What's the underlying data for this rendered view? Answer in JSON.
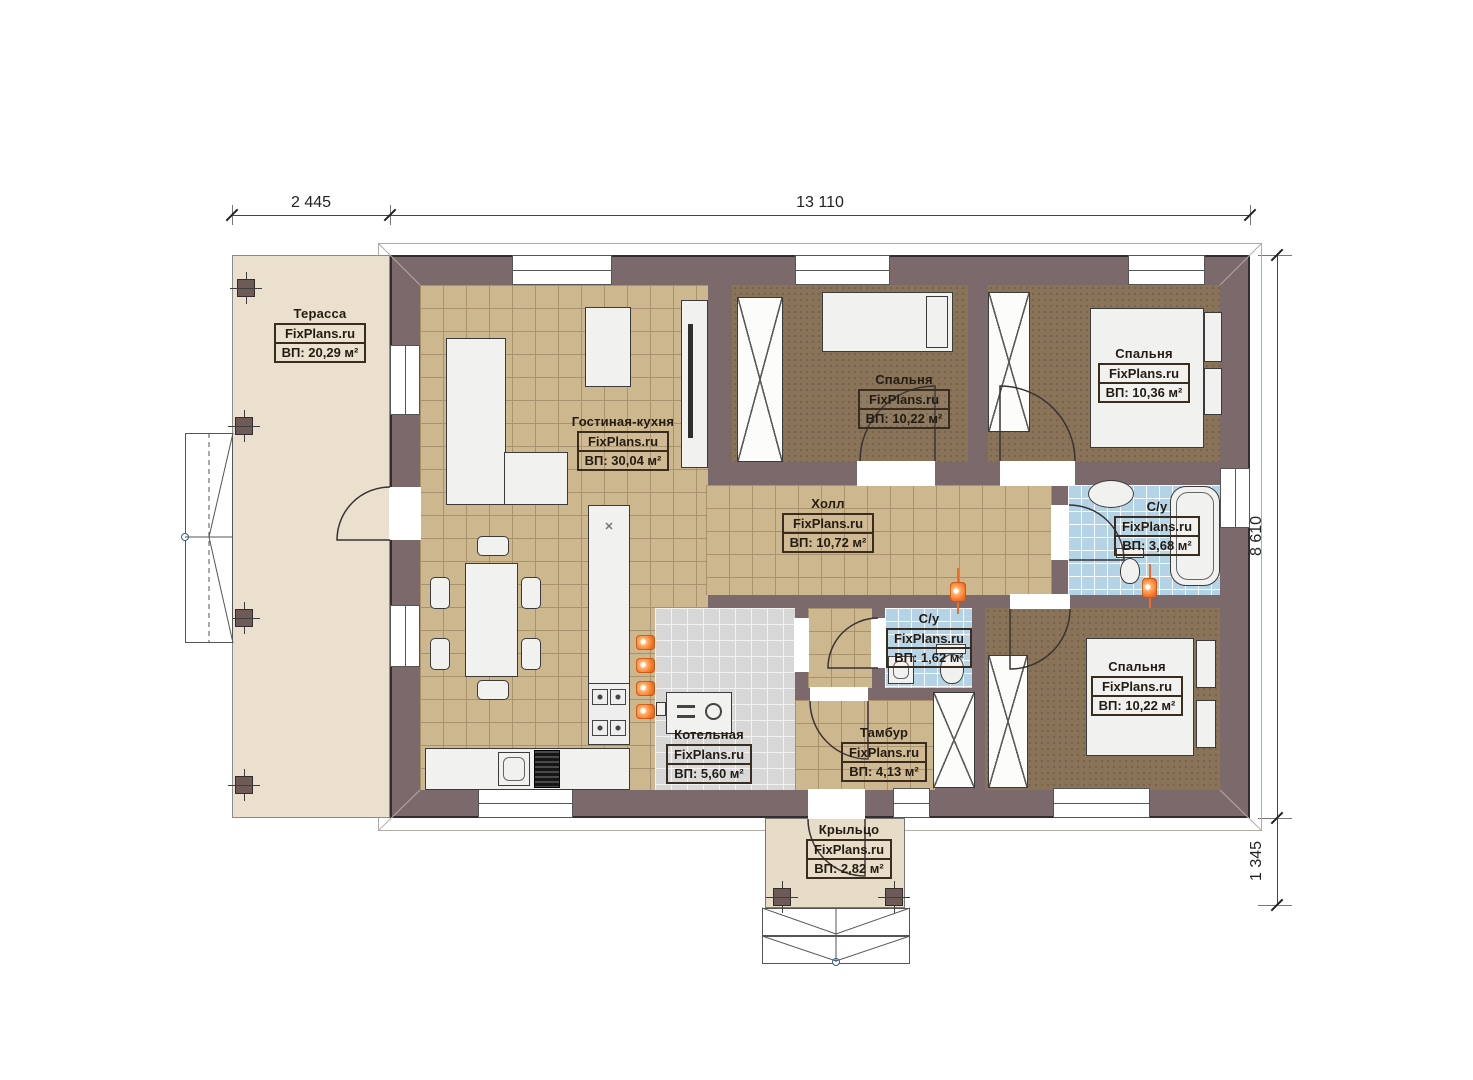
{
  "brand": "FixPlans.ru",
  "dimensions": {
    "terrace_width": "2 445",
    "house_width": "13 110",
    "house_depth": "8 610",
    "porch_depth": "1 345"
  },
  "rooms": [
    {
      "id": "terrace",
      "name": "Терасса",
      "area": "ВП: 20,29 м²"
    },
    {
      "id": "living-kitchen",
      "name": "Гостиная-кухня",
      "area": "ВП: 30,04 м²"
    },
    {
      "id": "bedroom-top",
      "name": "Спальня",
      "area": "ВП: 10,22 м²"
    },
    {
      "id": "bedroom-right",
      "name": "Спальня",
      "area": "ВП: 10,36 м²"
    },
    {
      "id": "hall",
      "name": "Холл",
      "area": "ВП: 10,72 м²"
    },
    {
      "id": "bathroom",
      "name": "С/у",
      "area": "ВП: 3,68 м²"
    },
    {
      "id": "wc",
      "name": "С/у",
      "area": "ВП: 1,62 м²"
    },
    {
      "id": "boiler",
      "name": "Котельная",
      "area": "ВП: 5,60 м²"
    },
    {
      "id": "vestibule",
      "name": "Тамбур",
      "area": "ВП: 4,13 м²"
    },
    {
      "id": "bedroom-bottom",
      "name": "Спальня",
      "area": "ВП: 10,22 м²"
    },
    {
      "id": "porch",
      "name": "Крыльцо",
      "area": "ВП: 2,82 м²"
    }
  ],
  "icons": {
    "hob_mark": "✕"
  },
  "colors": {
    "wall": "#7c696b",
    "floor_tile_tan": "#cdb78f",
    "floor_carpet_brown": "#8a7459",
    "floor_tile_blue": "#b5d3e6",
    "floor_tile_gray": "#d7d7d7",
    "terrace_floor": "#eae0cd",
    "accent_orange": "#f46a1f"
  }
}
